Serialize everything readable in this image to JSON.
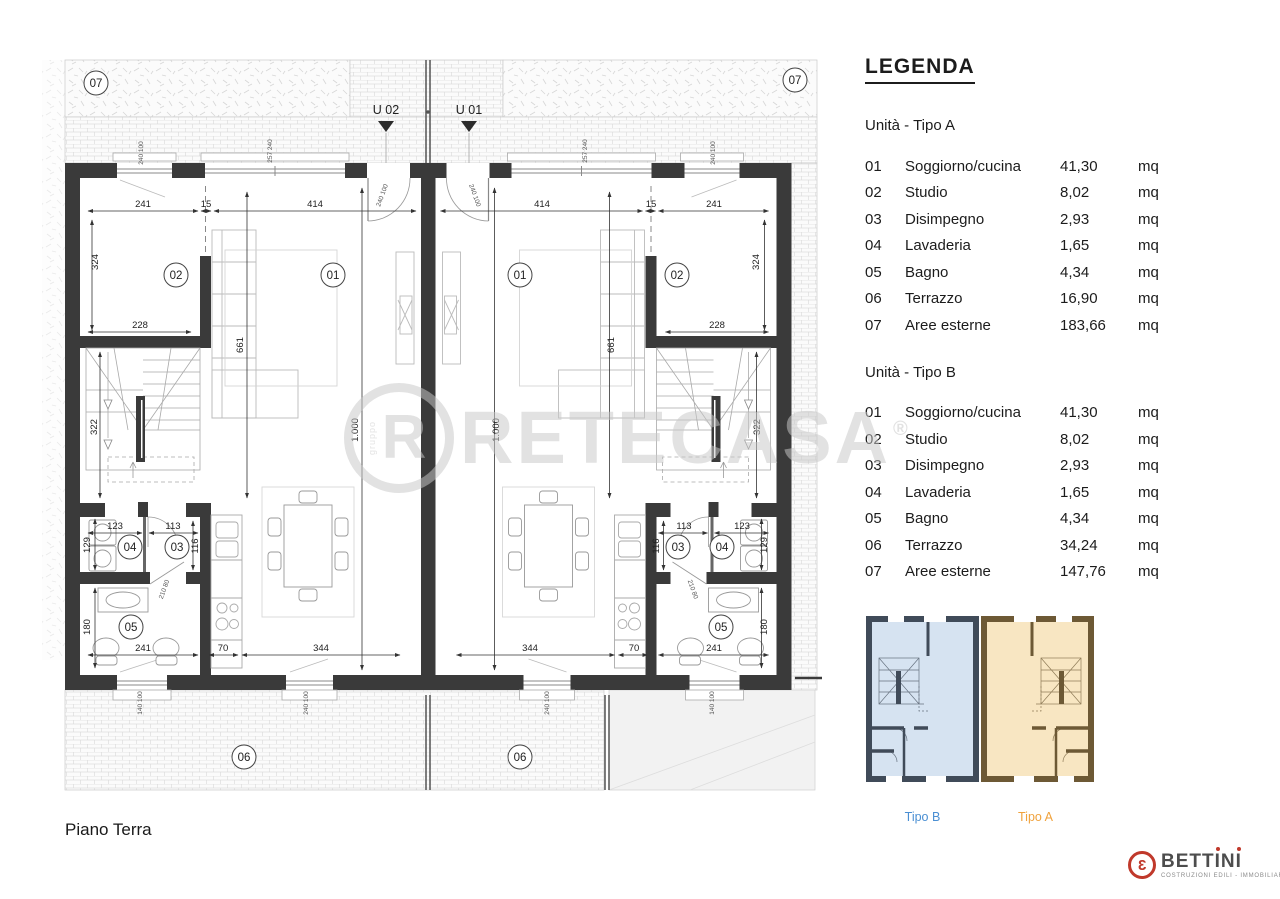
{
  "plan": {
    "floor_label": "Piano Terra",
    "unit_markers": {
      "u02": "U 02",
      "u01": "U 01"
    },
    "rooms": {
      "r01": "01",
      "r02": "02",
      "r03": "03",
      "r04": "04",
      "r05": "05",
      "r06": "06",
      "r07": "07"
    },
    "dims": {
      "n241": "241",
      "n15": "15",
      "n414": "414",
      "n324": "324",
      "n228": "228",
      "n661": "661",
      "n1000": "1.000",
      "n322": "322",
      "n123": "123",
      "n113": "113",
      "n129": "129",
      "n116": "116",
      "n180": "180",
      "n70": "70",
      "n344": "344",
      "door": "210 80",
      "w240100": "240 100",
      "w140100": "140 100",
      "w257240": "257 240"
    }
  },
  "legend": {
    "title": "LEGENDA",
    "tipo_a": {
      "heading": "Unità - Tipo A",
      "rows": [
        {
          "num": "01",
          "name": "Soggiorno/cucina",
          "value": "41,30",
          "unit": "mq"
        },
        {
          "num": "02",
          "name": "Studio",
          "value": "8,02",
          "unit": "mq"
        },
        {
          "num": "03",
          "name": "Disimpegno",
          "value": "2,93",
          "unit": "mq"
        },
        {
          "num": "04",
          "name": "Lavaderia",
          "value": "1,65",
          "unit": "mq"
        },
        {
          "num": "05",
          "name": "Bagno",
          "value": "4,34",
          "unit": "mq"
        },
        {
          "num": "06",
          "name": "Terrazzo",
          "value": "16,90",
          "unit": "mq"
        },
        {
          "num": "07",
          "name": "Aree esterne",
          "value": "183,66",
          "unit": "mq"
        }
      ]
    },
    "tipo_b": {
      "heading": "Unità - Tipo B",
      "rows": [
        {
          "num": "01",
          "name": "Soggiorno/cucina",
          "value": "41,30",
          "unit": "mq"
        },
        {
          "num": "02",
          "name": "Studio",
          "value": "8,02",
          "unit": "mq"
        },
        {
          "num": "03",
          "name": "Disimpegno",
          "value": "2,93",
          "unit": "mq"
        },
        {
          "num": "04",
          "name": "Lavaderia",
          "value": "1,65",
          "unit": "mq"
        },
        {
          "num": "05",
          "name": "Bagno",
          "value": "4,34",
          "unit": "mq"
        },
        {
          "num": "06",
          "name": "Terrazzo",
          "value": "34,24",
          "unit": "mq"
        },
        {
          "num": "07",
          "name": "Aree esterne",
          "value": "147,76",
          "unit": "mq"
        }
      ]
    },
    "thumbnails": {
      "tipo_b_label": "Tipo B",
      "tipo_a_label": "Tipo A"
    }
  },
  "watermark": {
    "text": "RETECASA",
    "emblem_letter": "R",
    "vertical_text": "gruppo",
    "reg": "®"
  },
  "logo": {
    "mark": "3",
    "part1": "BETT",
    "i1": "I",
    "part2": "N",
    "i2": "I",
    "subtitle": "COSTRUZIONI EDILI  -  IMMOBILIARE"
  },
  "colors": {
    "wall": "#3a3a3a",
    "tipo_b_fill": "#d6e3f1",
    "tipo_b_wall": "#404b59",
    "tipo_b_label": "#4a8fd3",
    "tipo_a_fill": "#f8e6c2",
    "tipo_a_wall": "#6d5935",
    "tipo_a_label": "#f0a23c",
    "accent_red": "#c0392b"
  }
}
